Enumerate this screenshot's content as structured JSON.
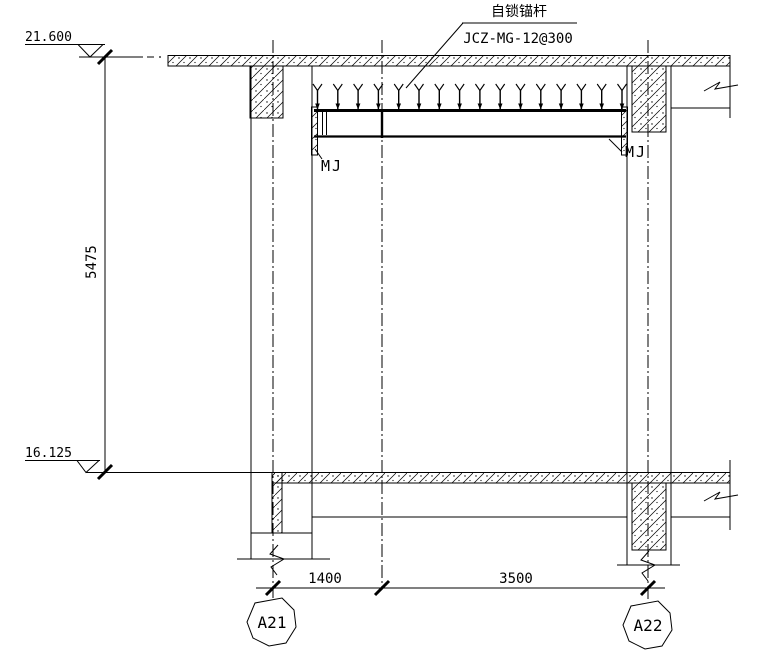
{
  "drawing": {
    "annotations": {
      "anchor_name": "自锁锚杆",
      "anchor_spec": "JCZ-MG-12@300",
      "embed_plate_left": "MJ",
      "embed_plate_right": "MJ"
    },
    "elevations": {
      "top": "21.600",
      "bottom": "16.125"
    },
    "dimensions": {
      "vertical": "5475",
      "span_left": "1400",
      "span_right": "3500"
    },
    "grid_bubbles": {
      "left": "A21",
      "right": "A22"
    },
    "colors": {
      "line": "#000000",
      "background": "#ffffff"
    }
  }
}
